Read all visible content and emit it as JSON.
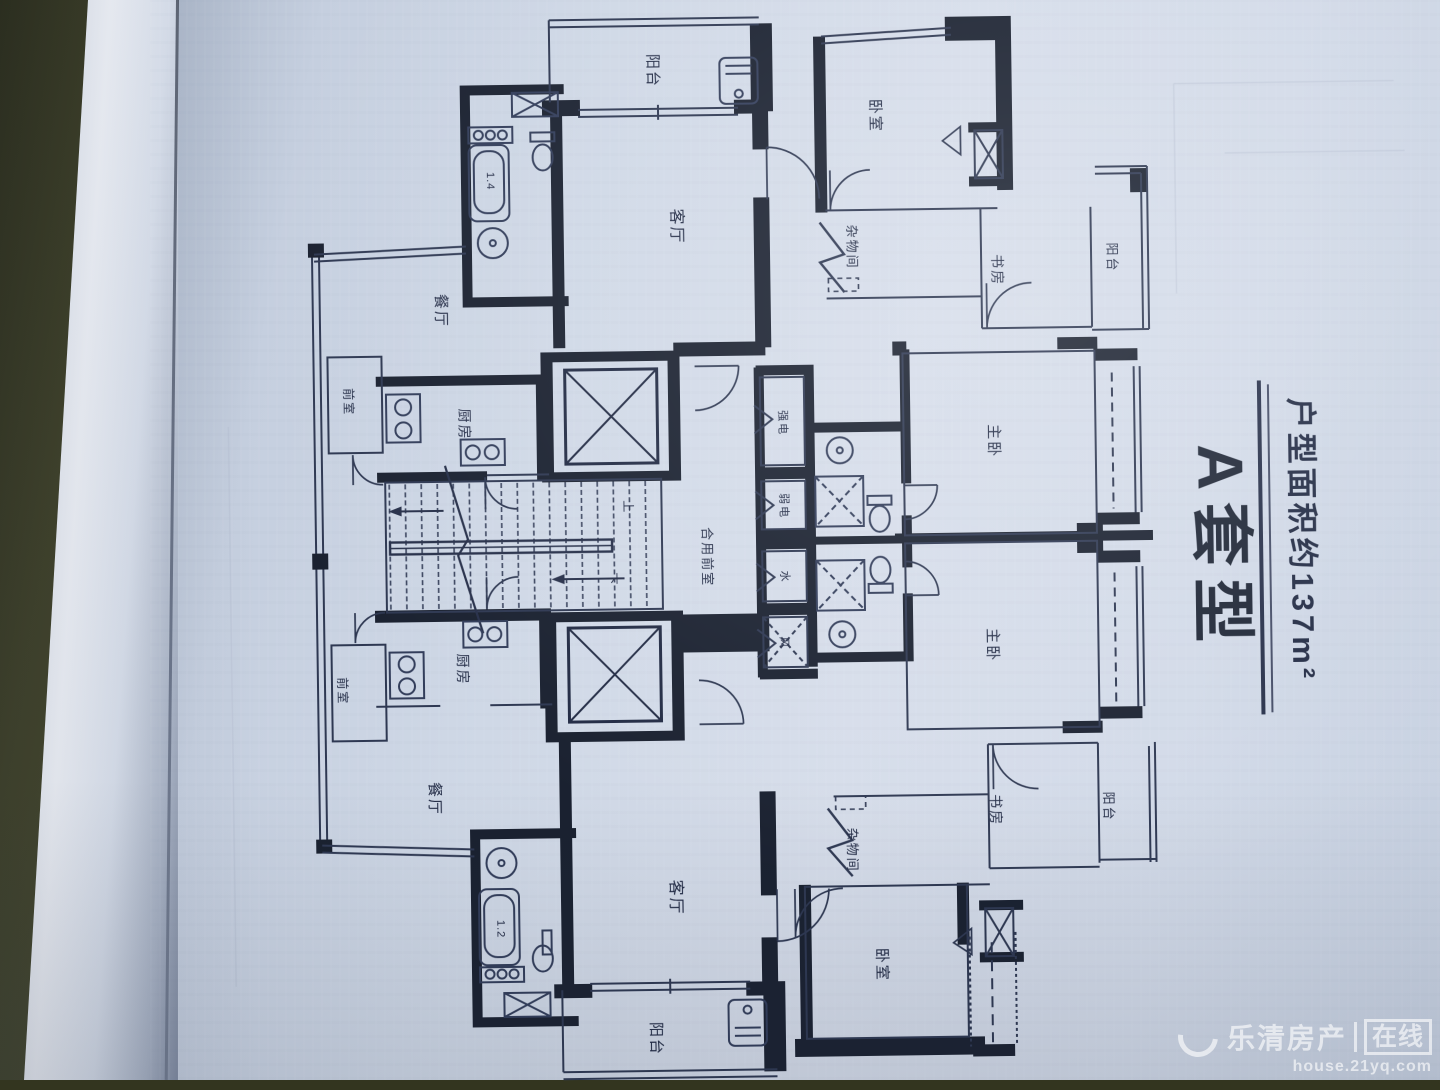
{
  "page": {
    "paper_color": "#d2dae8",
    "ink_color": "#1b2232",
    "book_edge_color": "#3f4129"
  },
  "title": {
    "name": "A套型",
    "subtitle": "户型面积约137m²"
  },
  "rooms": {
    "balcony": "阳台",
    "bedroom": "卧室",
    "living_room": "客厅",
    "dining_room": "餐厅",
    "kitchen": "厨房",
    "vestibule": "前室",
    "shared_vestibule": "合用前室",
    "storage_room": "杂物间",
    "study": "书房",
    "master_bedroom": "主卧"
  },
  "shafts": {
    "strong_electric": "强电",
    "weak_electric": "弱电",
    "water": "水",
    "air": "风"
  },
  "stairs": {
    "up": "上",
    "down": "下"
  },
  "fixtures": {
    "bathtub_top": "1.4",
    "bathtub_bottom": "1.2"
  },
  "watermark": {
    "brand": "乐清房产",
    "badge": "在线",
    "url": "house.21yq.com"
  }
}
